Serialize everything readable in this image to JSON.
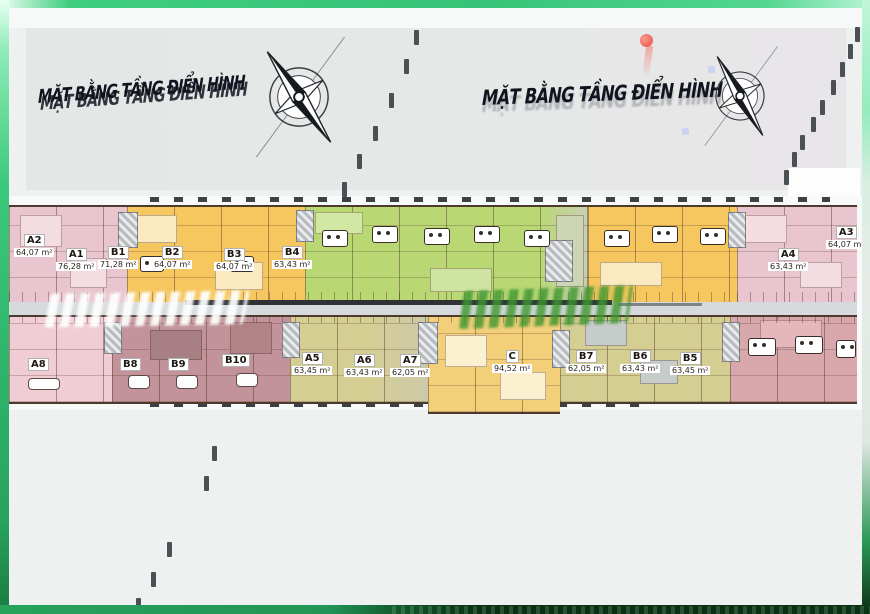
{
  "header": {
    "title_left": "MẶT BẰNG TẦNG ĐIỂN HÌNH",
    "title_right": "MẶT BẰNG TẦNG ĐIỂN HÌNH"
  },
  "colors": {
    "frame_green": "#3ecb7e",
    "frame_dark_green": "#0b2f13",
    "unit_pink": "#e9c6cf",
    "unit_yellow": "#f5c75e",
    "unit_green": "#b9d873",
    "unit_olive": "#d5ce92",
    "unit_mauve": "#c2939a",
    "north_marker": "#ef6a60"
  },
  "plan": {
    "top": [
      {
        "code": "A2",
        "area": "64,07 m²"
      },
      {
        "code": "A1",
        "area": "76,28 m²"
      },
      {
        "code": "B1",
        "area": "71,28 m²"
      },
      {
        "code": "B2",
        "area": "64,07 m²"
      },
      {
        "code": "B3",
        "area": "64,07 m²"
      },
      {
        "code": "B4",
        "area": "63,43 m²"
      },
      {
        "code": "A4",
        "area": "63,43 m²"
      },
      {
        "code": "A3",
        "area": "64,07 m²"
      }
    ],
    "bottom": [
      {
        "code": "A8",
        "area": ""
      },
      {
        "code": "B8",
        "area": ""
      },
      {
        "code": "B9",
        "area": ""
      },
      {
        "code": "B10",
        "area": ""
      },
      {
        "code": "A5",
        "area": "63,45 m²"
      },
      {
        "code": "A6",
        "area": "63,43 m²"
      },
      {
        "code": "A7",
        "area": "62,05 m²"
      },
      {
        "code": "C",
        "area": "94,52 m²"
      },
      {
        "code": "B7",
        "area": "62,05 m²"
      },
      {
        "code": "B6",
        "area": "63,43 m²"
      },
      {
        "code": "B5",
        "area": "63,45 m²"
      }
    ]
  }
}
